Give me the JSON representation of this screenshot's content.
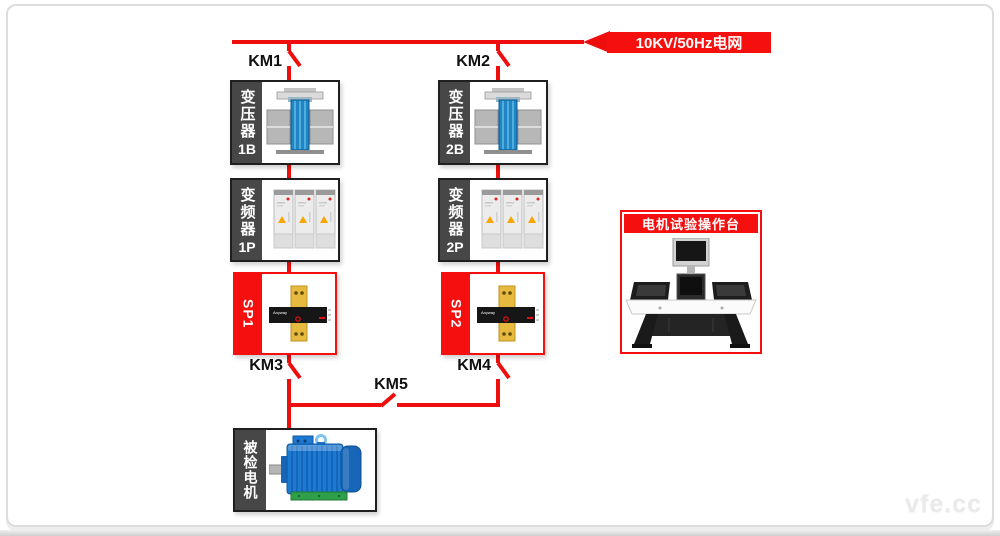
{
  "grid_label": "10KV/50Hz电网",
  "tie_breaker": "KM5",
  "motor_label": "被检电机",
  "console_title": "电机试验操作台",
  "watermark": "vfe.cc",
  "branches": [
    {
      "inlet_breaker": "KM1",
      "transformer": {
        "name": "变压器",
        "id": "1B"
      },
      "converter": {
        "name": "变频器",
        "id": "1P"
      },
      "sensor": {
        "id": "SP1",
        "brand": "Anyway"
      },
      "outlet_breaker": "KM3"
    },
    {
      "inlet_breaker": "KM2",
      "transformer": {
        "name": "变压器",
        "id": "2B"
      },
      "converter": {
        "name": "变频器",
        "id": "2P"
      },
      "sensor": {
        "id": "SP2",
        "brand": "Anyway"
      },
      "outlet_breaker": "KM4"
    }
  ],
  "colors": {
    "line_red": "#ee0e0e",
    "label_red": "#f50f0f",
    "strip_gray": "#474747",
    "border_dark": "#1f1f1f",
    "card_border": "#dcdcdc"
  }
}
